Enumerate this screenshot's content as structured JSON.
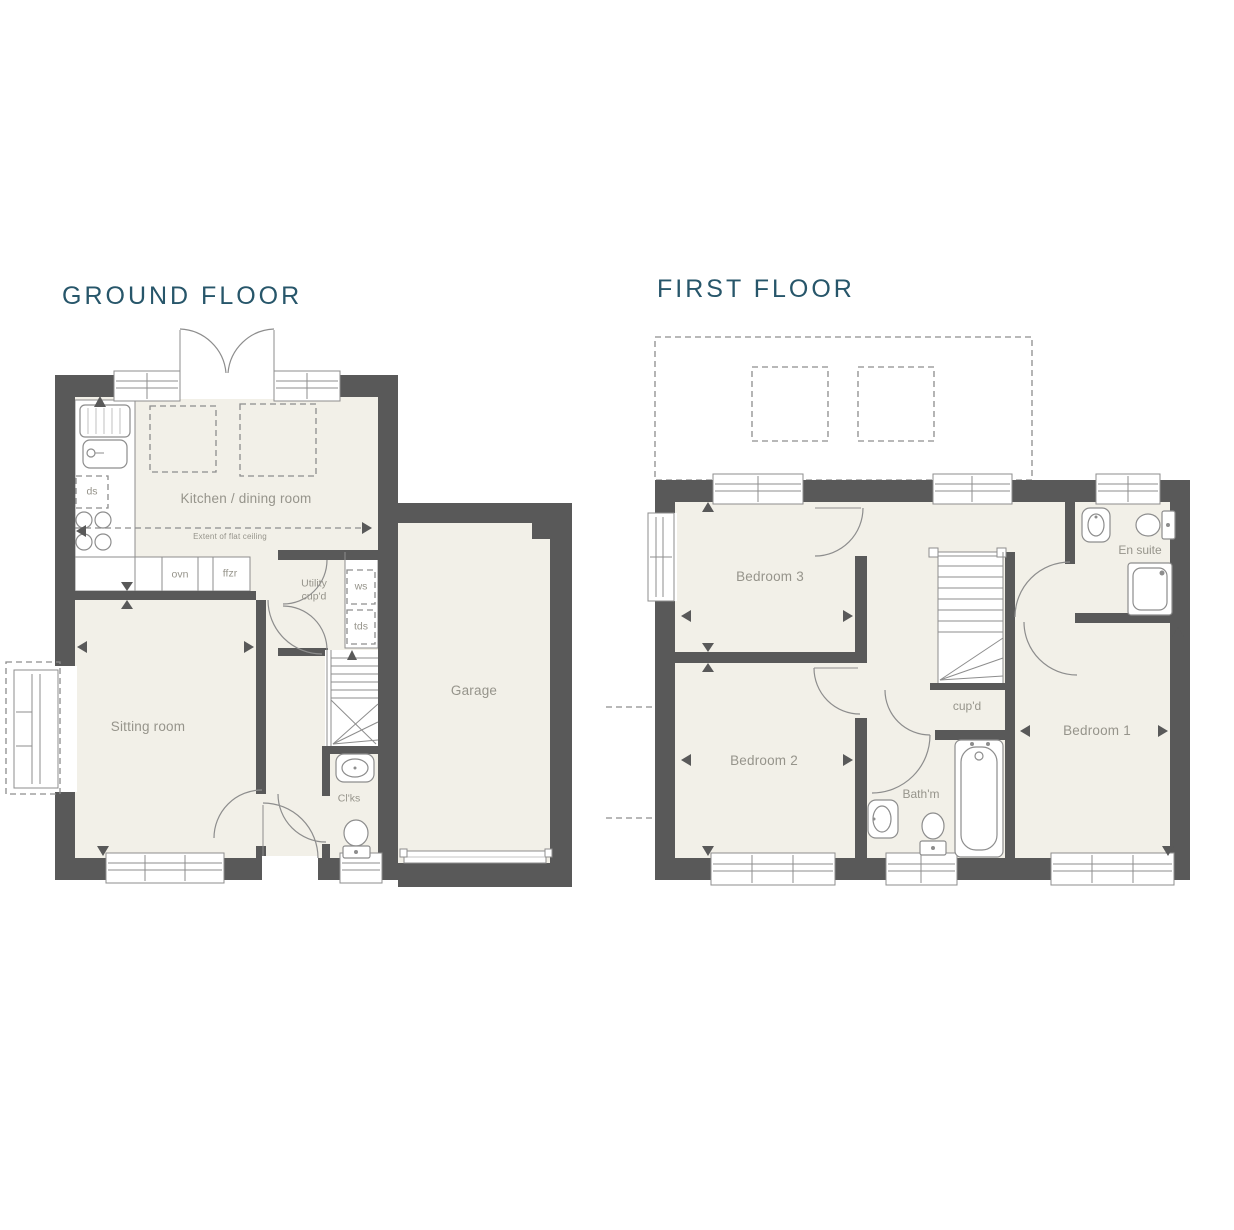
{
  "palette": {
    "bg": "#ffffff",
    "wall": "#595959",
    "floor": "#f2f0e8",
    "line": "#8d8d8d",
    "dash": "#8d8d8d",
    "label": "#96948b",
    "title": "#27566a"
  },
  "ground_floor": {
    "title": "GROUND FLOOR",
    "labels": {
      "kitchen": "Kitchen / dining room",
      "ceiling_note": "Extent of flat ceiling",
      "ds": "ds",
      "ovn": "ovn",
      "ffzr": "ffzr",
      "utility": "Utility\ncup'd",
      "ws": "ws",
      "tds": "tds",
      "sitting": "Sitting room",
      "cloaks": "Cl'ks",
      "garage": "Garage"
    }
  },
  "first_floor": {
    "title": "FIRST FLOOR",
    "labels": {
      "bedroom3": "Bedroom 3",
      "bedroom2": "Bedroom 2",
      "bedroom1": "Bedroom 1",
      "ensuite": "En suite",
      "cupboard": "cup'd",
      "bathroom": "Bath'm"
    }
  }
}
